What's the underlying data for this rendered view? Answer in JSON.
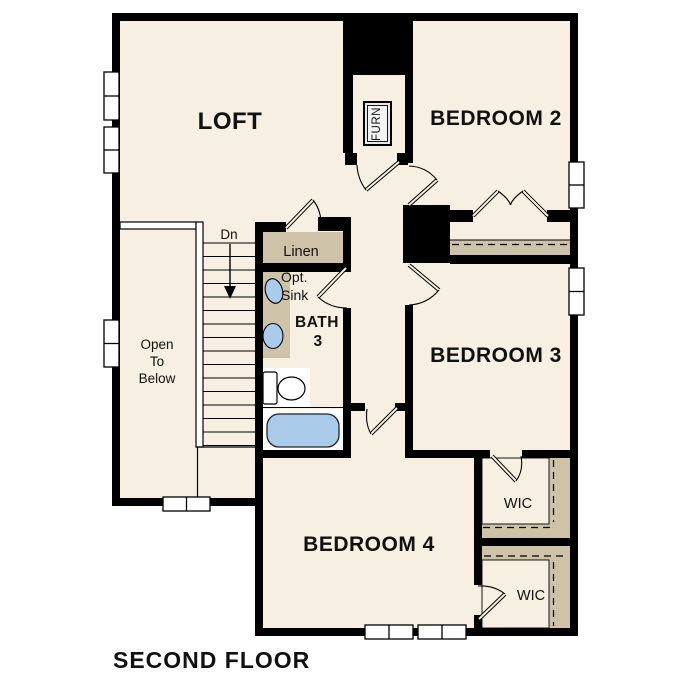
{
  "title": "SECOND FLOOR",
  "colors": {
    "floor": "#f6efe2",
    "shelf_tan": "#cec2a8",
    "wall": "#000000",
    "fixture_blue": "#aacbe9",
    "window_white": "#ffffff"
  },
  "rooms": {
    "loft": {
      "label": "LOFT"
    },
    "bedroom2": {
      "label": "BEDROOM 2"
    },
    "bedroom3": {
      "label": "BEDROOM 3"
    },
    "bedroom4": {
      "label": "BEDROOM 4"
    },
    "bath3": {
      "line1": "BATH",
      "line2": "3"
    },
    "linen": {
      "label": "Linen"
    },
    "furnace": {
      "label": "FURN"
    },
    "wic_upper": {
      "label": "WIC"
    },
    "wic_lower": {
      "label": "WIC"
    },
    "open_to_below": {
      "line1": "Open",
      "line2": "To",
      "line3": "Below"
    }
  },
  "annotations": {
    "opt_sink": {
      "line1": "Opt.",
      "line2": "Sink"
    },
    "stairs": {
      "down_label": "Dn"
    }
  }
}
